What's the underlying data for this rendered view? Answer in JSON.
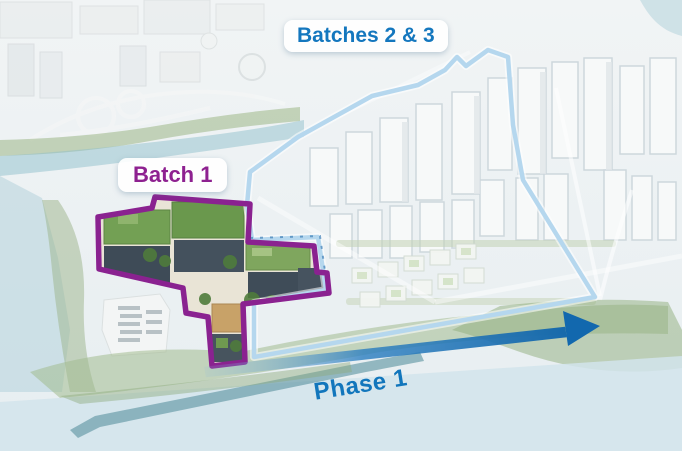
{
  "annotations": {
    "batch1": {
      "label": "Batch 1",
      "text_color": "#8e2190",
      "outline_color": "#8a2290"
    },
    "batches23": {
      "label": "Batches 2 & 3",
      "text_color": "#1477be",
      "outline_color": "#b5d7ee"
    },
    "phase1": {
      "label": "Phase 1",
      "text_color": "#1276bc",
      "arrow_color": "#1268ae"
    }
  }
}
